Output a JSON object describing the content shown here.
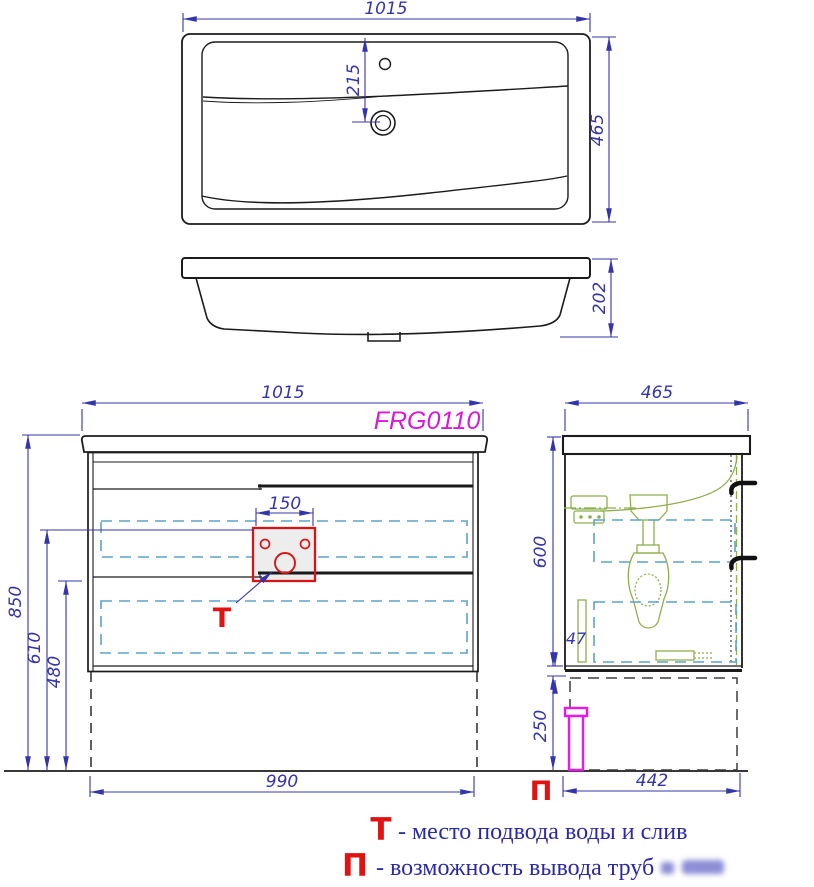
{
  "page": {
    "product_code": "FRG0110"
  },
  "top_view": {
    "width": "1015",
    "depth": "465",
    "faucet_offset": "215"
  },
  "profile_view": {
    "height": "202"
  },
  "front_view": {
    "width": "1015",
    "product_code": "FRG0110",
    "cutout_width": "150",
    "height_total": "850",
    "height_supply": "610",
    "height_drain": "480",
    "base_width": "990",
    "marker": "Т"
  },
  "side_view": {
    "depth": "465",
    "height_body": "600",
    "gap": "47",
    "height_plinth": "250",
    "base_depth": "442",
    "marker": "П"
  },
  "legend": {
    "t_marker": "Т",
    "t_text": "- место подвода воды и слив",
    "p_marker": "П",
    "p_text": "- возможность вывода труб"
  },
  "colors": {
    "dimension_blue": "#3434ab",
    "line_black": "#1b1b1b",
    "accent_red": "#e01212",
    "product_magenta": "#d81ad8",
    "pipe_magenta": "#ea16ea",
    "drawer_cyan": "#5ba3c9",
    "fitting_green": "#8fae4e"
  }
}
